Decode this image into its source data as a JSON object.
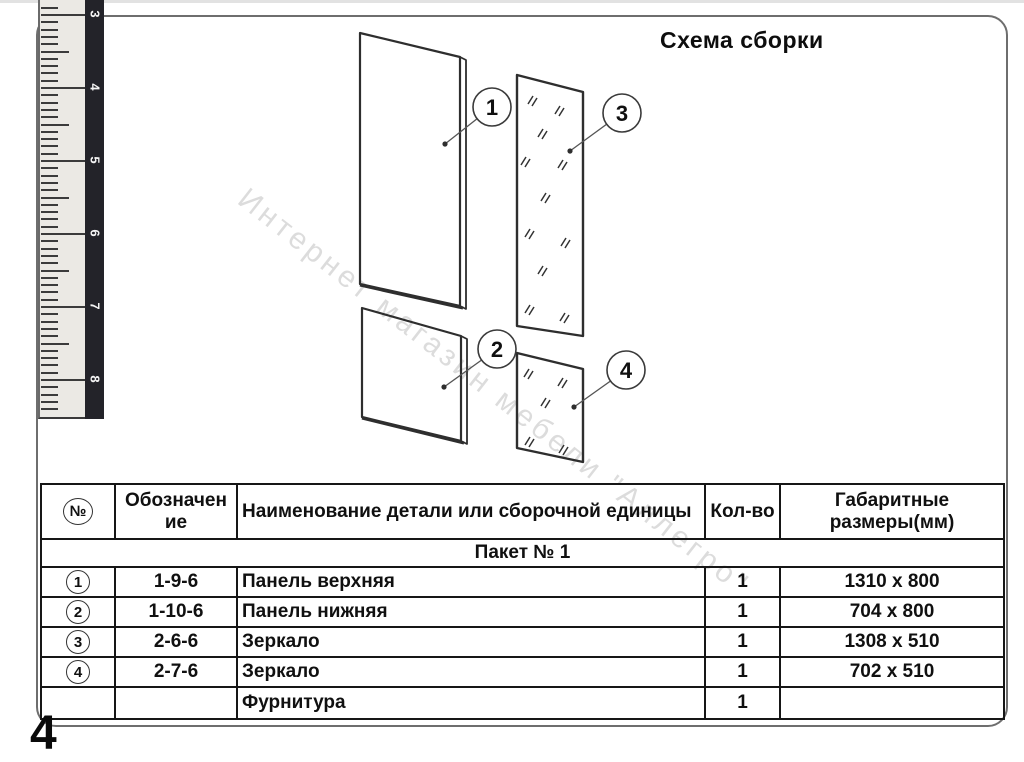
{
  "header": {
    "title": "Схема сборки"
  },
  "watermark": {
    "text": "Интернет магазин мебели \"Аллегро\""
  },
  "ruler": {
    "labels": [
      "3",
      "4",
      "5",
      "6",
      "7",
      "8"
    ]
  },
  "diagram": {
    "callouts": [
      {
        "n": "1"
      },
      {
        "n": "2"
      },
      {
        "n": "3"
      },
      {
        "n": "4"
      }
    ]
  },
  "table": {
    "headers": {
      "num": "№",
      "designation": "Обозначение",
      "name": "Наименование детали или сборочной единицы",
      "qty": "Кол-во",
      "dims": "Габаритные размеры(мм)"
    },
    "package_row": "Пакет № 1",
    "rows": [
      {
        "num": "1",
        "designation": "1-9-6",
        "name": "Панель верхняя",
        "qty": "1",
        "dims": "1310 x 800"
      },
      {
        "num": "2",
        "designation": "1-10-6",
        "name": "Панель нижняя",
        "qty": "1",
        "dims": "704 x 800"
      },
      {
        "num": "3",
        "designation": "2-6-6",
        "name": "Зеркало",
        "qty": "1",
        "dims": "1308 x 510"
      },
      {
        "num": "4",
        "designation": "2-7-6",
        "name": "Зеркало",
        "qty": "1",
        "dims": "702 x 510"
      },
      {
        "num": "",
        "designation": "",
        "name": "Фурнитура",
        "qty": "1",
        "dims": ""
      }
    ]
  },
  "page": {
    "number": "4"
  }
}
